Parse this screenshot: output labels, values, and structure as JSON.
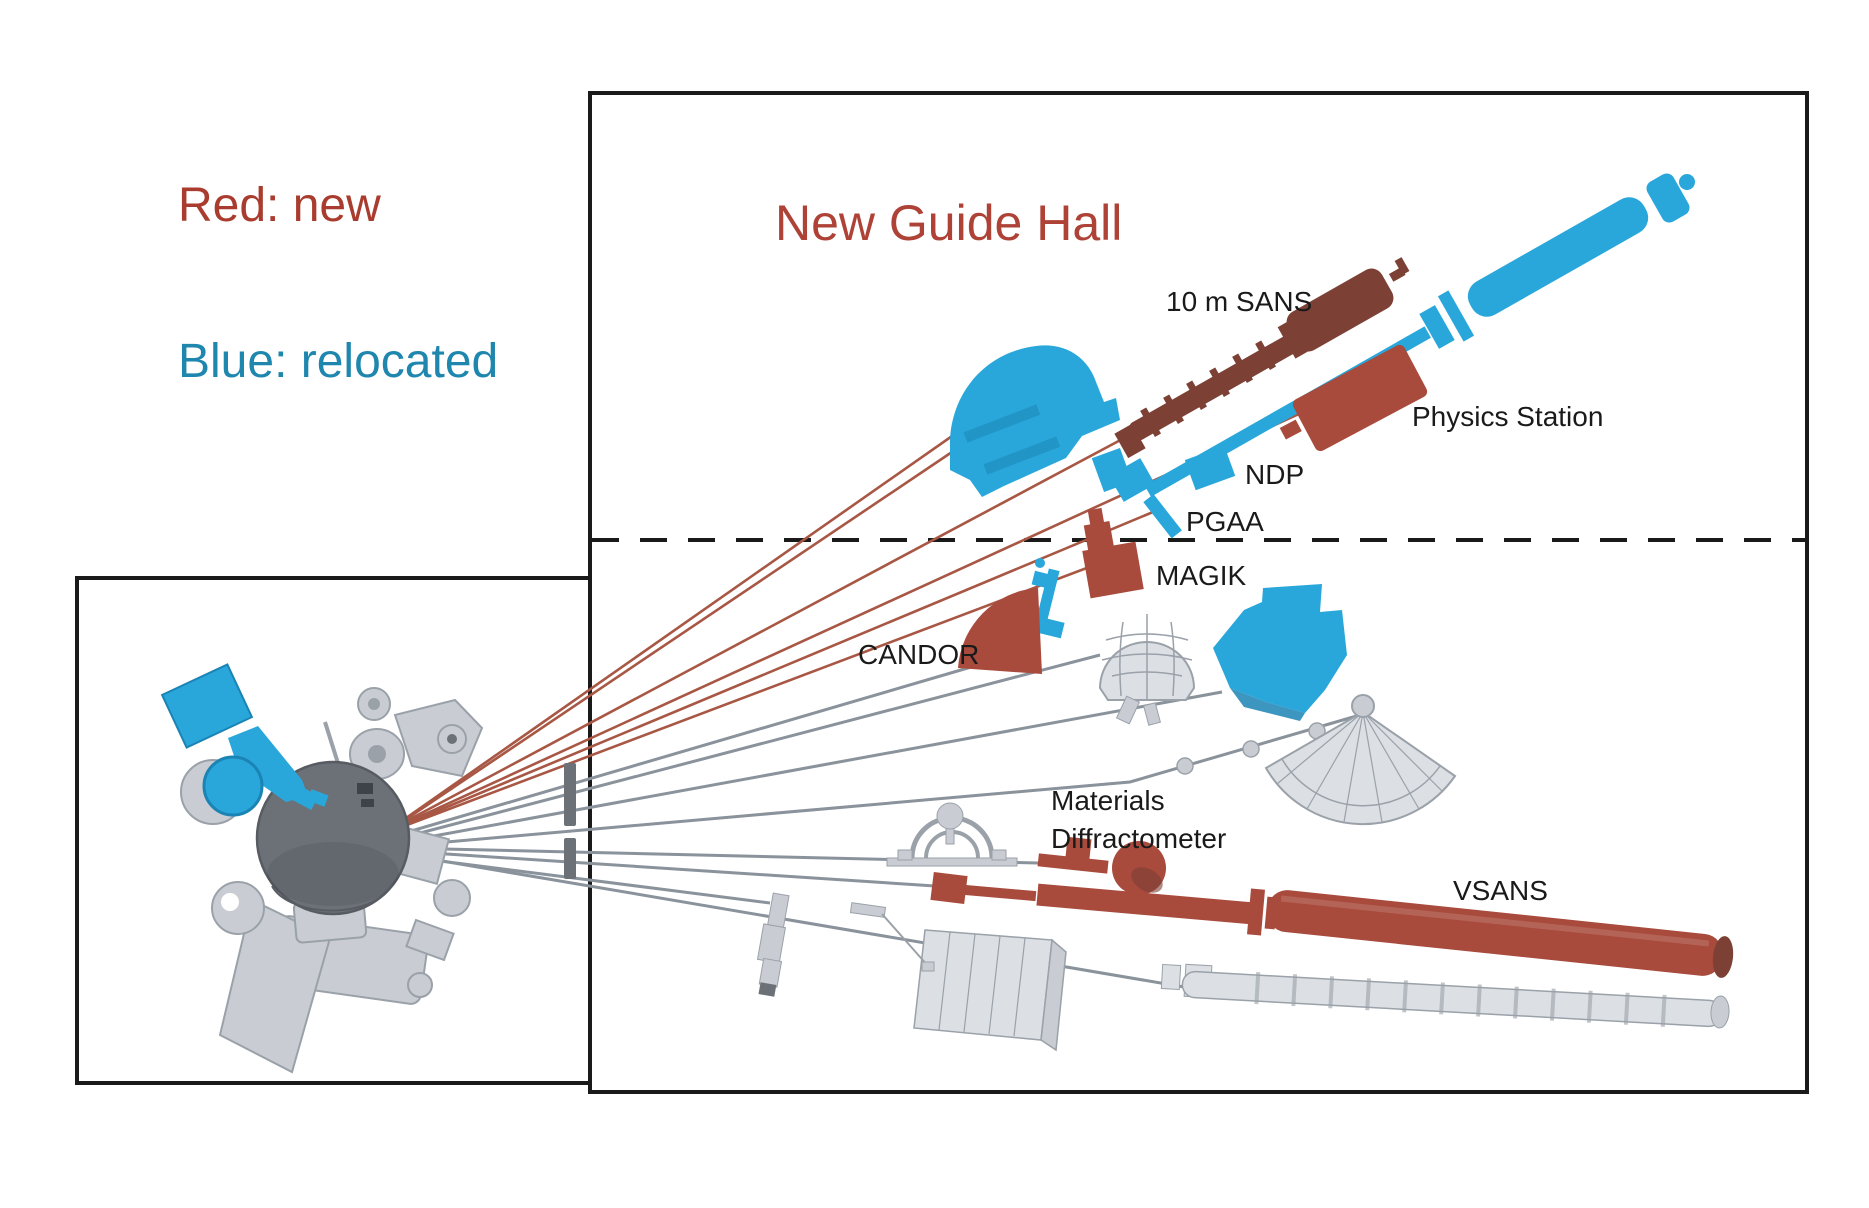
{
  "title": "New Guide Hall",
  "legend": {
    "red_label": "Red:  new",
    "blue_label": "Blue:  relocated"
  },
  "labels": {
    "sans10": "10 m SANS",
    "physics": "Physics Station",
    "ndp": "NDP",
    "pgaa": "PGAA",
    "magik": "MAGIK",
    "candor": "CANDOR",
    "materials_line1": "Materials",
    "materials_line2": "Diffractometer",
    "vsans": "VSANS"
  },
  "colors": {
    "ink": "#1a1a1a",
    "legendRed": "#a93c2e",
    "legendBlue": "#1f86ae",
    "titleRed": "#ae4237",
    "red": "#a84a3c",
    "redDark": "#7c4035",
    "lineRed": "#a85744",
    "blue": "#29a7db",
    "blueDark": "#1b84b4",
    "grayLight": "#c9cdd3",
    "grayLighter": "#dce0e5",
    "grayMid": "#9aa1a9",
    "grayDark": "#6c7178",
    "lineGray": "#8a929b"
  }
}
